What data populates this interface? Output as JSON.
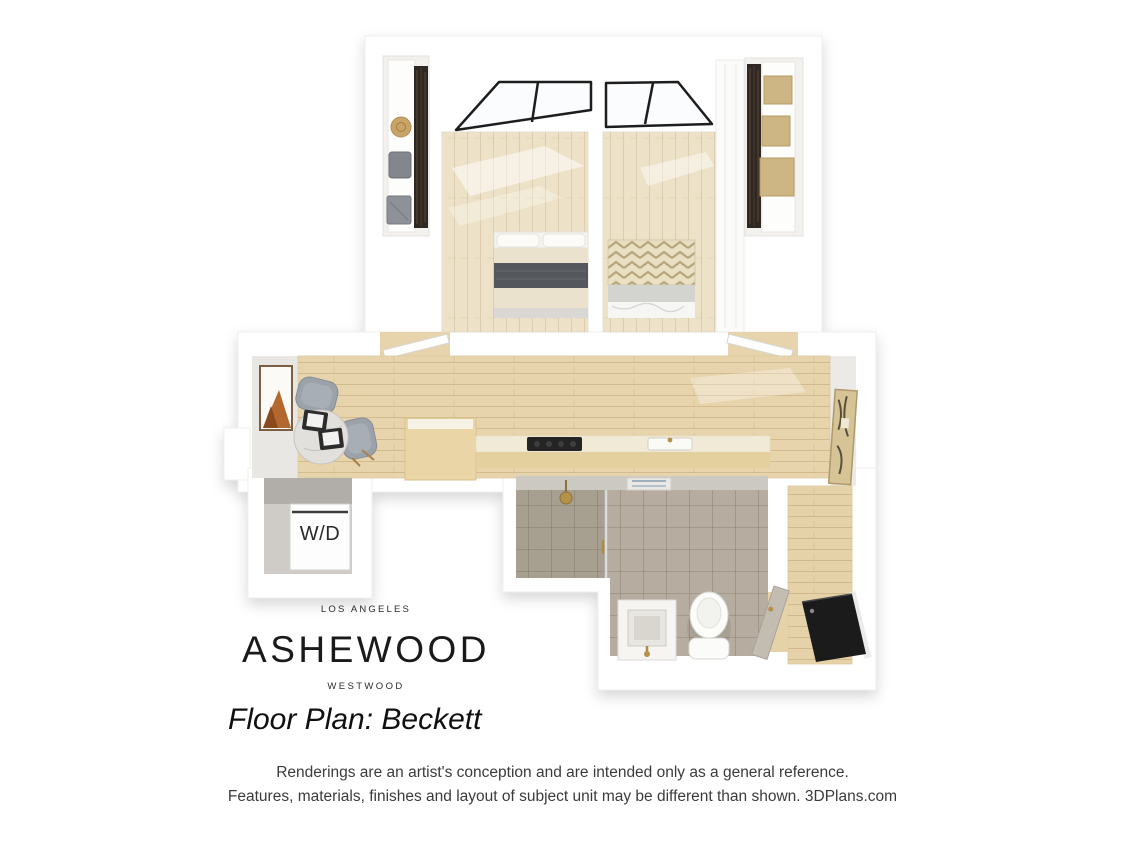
{
  "branding": {
    "city": "LOS ANGELES",
    "property_name": "ASHEWOOD",
    "neighborhood": "WESTWOOD",
    "plan_title": "Floor Plan: Beckett"
  },
  "floor_plan": {
    "washer_dryer_label": "W/D"
  },
  "disclaimer": {
    "line1": "Renderings are an artist's conception and are intended only as a general reference.",
    "line2": "Features, materials, finishes and layout of subject unit may be different than shown. 3DPlans.com"
  },
  "colors": {
    "background": "#ffffff",
    "wall": "#ffffff",
    "bedroom_floor": "#ede2c8",
    "living_floor": "#e7d4ac",
    "corridor_floor": "#e5d2a9",
    "bathroom_tile": "#b6ada0",
    "shower_tile": "#a79e8f",
    "concrete": "#ccc8c2",
    "counter_front": "#e4cf9f",
    "counter_top": "#f1ead7",
    "cooktop": "#242424",
    "blanket_dark": "#54575c",
    "chevron_tan": "#b7a67a",
    "chair_gray": "#9ba2aa",
    "marble_table": "#e2e0dc",
    "art_copper": "#b2682f",
    "hall_art_tan": "#d6c497",
    "box_tan": "#cdb584",
    "brass": "#b5924b",
    "entry_door": "#1b1b1b",
    "text_dark": "#1a1a1a",
    "text_gray": "#3b3b3b"
  }
}
